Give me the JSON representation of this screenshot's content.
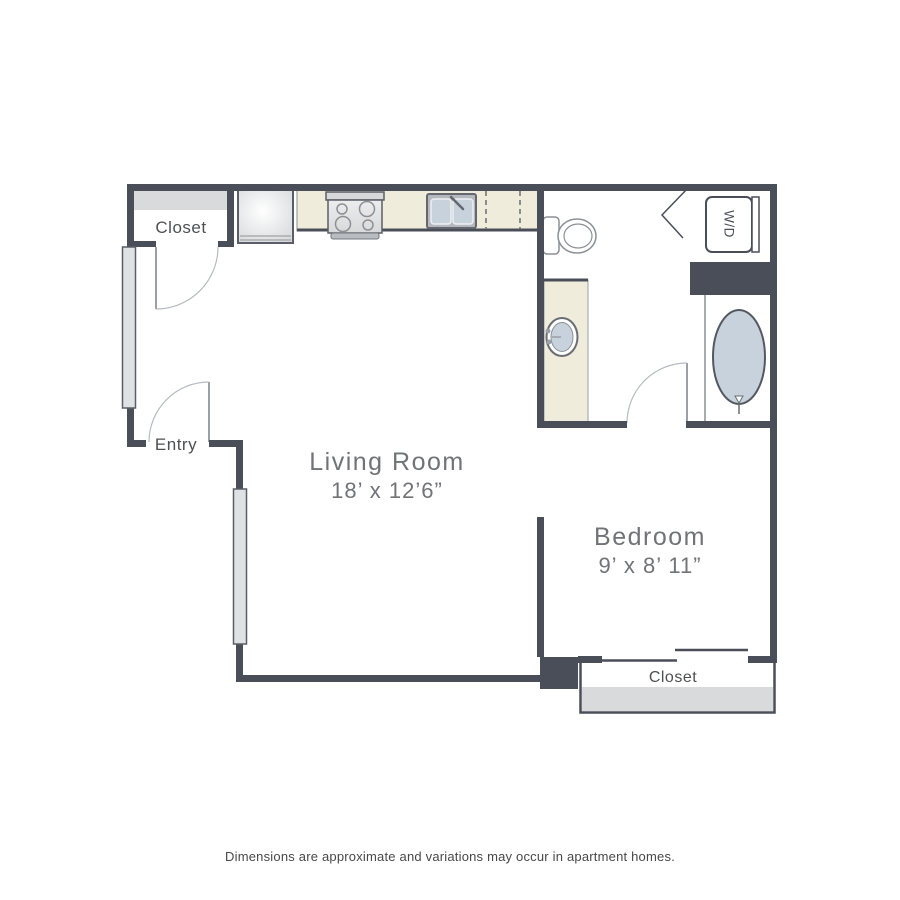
{
  "floor_plan": {
    "rooms": [
      {
        "name": "Living Room",
        "dimensions": "18’ x 12’6”"
      },
      {
        "name": "Bedroom",
        "dimensions": "9’ x 8’ 11”"
      }
    ],
    "labels": {
      "closet_top_left": "Closet",
      "entry": "Entry",
      "closet_bedroom": "Closet",
      "washer_dryer": "W/D"
    },
    "fixtures": [
      "refrigerator-icon",
      "stove-icon",
      "kitchen-sink-icon",
      "dishwasher-dashed-icon",
      "toilet-icon",
      "washer-dryer-icon",
      "bathroom-sink-icon",
      "bathtub-icon",
      "window-symbol",
      "door-swing-symbol",
      "sliding-door-symbol",
      "bifold-door-symbol"
    ],
    "colors": {
      "wall": "#4a4e58",
      "counter": "#f0ecdc",
      "fixture_fill": "#c7d2dc",
      "closet_shade": "#d9dadc",
      "window_fill": "#dfe2e5",
      "door_line": "#9aa0a6",
      "arc_line": "#b6bac0",
      "room_label_text": "#717376",
      "small_label_text": "#4f5052",
      "disclaimer_text": "#48484a"
    }
  },
  "footer": {
    "disclaimer": "Dimensions are approximate and variations may occur in apartment homes."
  }
}
